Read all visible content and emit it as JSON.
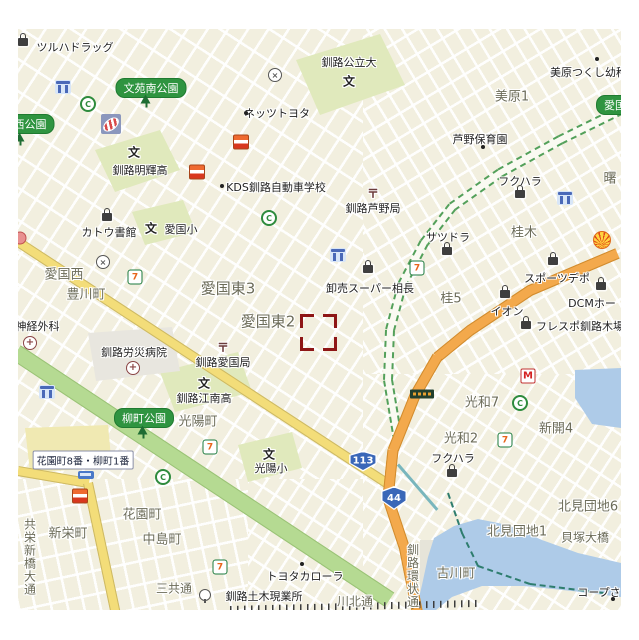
{
  "map": {
    "x": 18,
    "y": 29,
    "w": 603,
    "h": 581,
    "selection": {
      "x": 282,
      "y": 285,
      "w": 37,
      "h": 37
    },
    "colors": {
      "base": "#f2efdf",
      "road_yellow": "#f3dd79",
      "road_orange": "#f3a94c",
      "park_green": "#b5da92",
      "campus_green": "#e0e9bc",
      "water": "#aecbe8",
      "pill_green": "#2f9440",
      "selection_red": "#8e1616",
      "shield_blue": "#3a67b8"
    },
    "areas": [
      {
        "t": "美原1",
        "x": 512,
        "y": 95
      },
      {
        "t": "曙",
        "x": 610,
        "y": 177
      },
      {
        "t": "桂木",
        "x": 524,
        "y": 231
      },
      {
        "t": "桂5",
        "x": 451,
        "y": 297
      },
      {
        "t": "愛国西",
        "x": 64,
        "y": 273
      },
      {
        "t": "豊川町",
        "x": 86,
        "y": 293
      },
      {
        "t": "愛国東3",
        "x": 228,
        "y": 288,
        "s": 15
      },
      {
        "t": "愛国東2",
        "x": 268,
        "y": 321,
        "s": 15
      },
      {
        "t": "光陽町",
        "x": 198,
        "y": 420
      },
      {
        "t": "新栄町",
        "x": 68,
        "y": 532
      },
      {
        "t": "花園町",
        "x": 142,
        "y": 513
      },
      {
        "t": "中島町",
        "x": 162,
        "y": 538
      },
      {
        "t": "三共通",
        "x": 174,
        "y": 588,
        "s": 12
      },
      {
        "t": "光和7",
        "x": 482,
        "y": 401
      },
      {
        "t": "光和2",
        "x": 461,
        "y": 437
      },
      {
        "t": "新開4",
        "x": 556,
        "y": 427
      },
      {
        "t": "北見団地1",
        "x": 517,
        "y": 530
      },
      {
        "t": "北見団地6",
        "x": 588,
        "y": 505
      },
      {
        "t": "古川町",
        "x": 456,
        "y": 572
      },
      {
        "t": "貝塚大橋",
        "x": 585,
        "y": 537,
        "s": 12
      },
      {
        "t": "川北通",
        "x": 355,
        "y": 601,
        "s": 12
      }
    ],
    "pois": [
      {
        "t": "ツルハドラッグ",
        "x": 75,
        "y": 47
      },
      {
        "t": "釧路公立大",
        "x": 349,
        "y": 62
      },
      {
        "t": "ネッツトヨタ",
        "x": 277,
        "y": 113
      },
      {
        "t": "釧路明輝高",
        "x": 140,
        "y": 170
      },
      {
        "t": "カトウ書館",
        "x": 109,
        "y": 232
      },
      {
        "t": "愛国小",
        "x": 181,
        "y": 229
      },
      {
        "t": "KDS釧路自動車学校",
        "x": 276,
        "y": 187
      },
      {
        "t": "釧路芦野局",
        "x": 373,
        "y": 208
      },
      {
        "t": "サツドラ",
        "x": 448,
        "y": 237
      },
      {
        "t": "卸売スーパー相長",
        "x": 370,
        "y": 288
      },
      {
        "t": "スポーツデポ",
        "x": 557,
        "y": 278
      },
      {
        "t": "イオン",
        "x": 507,
        "y": 311
      },
      {
        "t": "DCMホー",
        "x": 592,
        "y": 303
      },
      {
        "t": "フレスポ釧路木場",
        "x": 580,
        "y": 326
      },
      {
        "t": "フクハラ",
        "x": 520,
        "y": 181
      },
      {
        "t": "フクハラ",
        "x": 453,
        "y": 458
      },
      {
        "t": "美原つくし幼稚園",
        "x": 594,
        "y": 72
      },
      {
        "t": "芦野保育園",
        "x": 480,
        "y": 139
      },
      {
        "t": "釧路労災病院",
        "x": 134,
        "y": 352
      },
      {
        "t": "釧路愛国局",
        "x": 223,
        "y": 362
      },
      {
        "t": "釧路江南高",
        "x": 204,
        "y": 398
      },
      {
        "t": "光陽小",
        "x": 271,
        "y": 468
      },
      {
        "t": "脳神経外科",
        "x": 32,
        "y": 326
      },
      {
        "t": "トヨタカローラ",
        "x": 305,
        "y": 576
      },
      {
        "t": "釧路土木現業所",
        "x": 264,
        "y": 596
      },
      {
        "t": "コープさ",
        "x": 599,
        "y": 592
      }
    ],
    "pills": [
      {
        "t": "文苑南公園",
        "x": 151,
        "y": 88
      },
      {
        "t": "西公園",
        "x": 30,
        "y": 124
      },
      {
        "t": "柳町公園",
        "x": 144,
        "y": 418
      },
      {
        "t": "愛国",
        "x": 615,
        "y": 105
      }
    ],
    "crossings": [
      {
        "t": "花園町8番・柳町1番",
        "x": 83,
        "y": 460
      }
    ],
    "verticals": [
      {
        "t": "共栄新橋大通",
        "x": 30,
        "y": 557
      },
      {
        "t": "釧路環状通",
        "x": 413,
        "y": 576
      }
    ],
    "shields": [
      {
        "t": "113",
        "x": 363,
        "y": 461,
        "w": 30,
        "h": 21
      },
      {
        "t": "44",
        "x": 394,
        "y": 498,
        "w": 28,
        "h": 24
      }
    ],
    "glyphs": [
      {
        "k": "school",
        "t": "文",
        "x": 349,
        "y": 81
      },
      {
        "k": "school",
        "t": "文",
        "x": 134,
        "y": 152
      },
      {
        "k": "school",
        "t": "文",
        "x": 151,
        "y": 228
      },
      {
        "k": "school",
        "t": "文",
        "x": 204,
        "y": 383
      },
      {
        "k": "school",
        "t": "文",
        "x": 269,
        "y": 454
      },
      {
        "k": "post",
        "t": "〒",
        "x": 373,
        "y": 193
      },
      {
        "k": "post",
        "t": "〒",
        "x": 223,
        "y": 347
      }
    ],
    "icons": [
      {
        "k": "bag",
        "x": 23,
        "y": 42
      },
      {
        "k": "bag",
        "x": 107,
        "y": 217
      },
      {
        "k": "bag",
        "x": 368,
        "y": 269
      },
      {
        "k": "bag",
        "x": 447,
        "y": 251
      },
      {
        "k": "bag",
        "x": 553,
        "y": 261
      },
      {
        "k": "bag",
        "x": 505,
        "y": 294
      },
      {
        "k": "bag",
        "x": 601,
        "y": 286
      },
      {
        "k": "bag",
        "x": 526,
        "y": 325
      },
      {
        "k": "bag",
        "x": 520,
        "y": 194
      },
      {
        "k": "bag",
        "x": 452,
        "y": 473
      },
      {
        "k": "seven",
        "x": 135,
        "y": 277
      },
      {
        "k": "seven",
        "x": 417,
        "y": 268
      },
      {
        "k": "seven",
        "x": 210,
        "y": 447
      },
      {
        "k": "seven",
        "x": 220,
        "y": 567
      },
      {
        "k": "seven",
        "x": 505,
        "y": 440
      },
      {
        "k": "seico",
        "x": 197,
        "y": 172
      },
      {
        "k": "seico",
        "x": 241,
        "y": 142
      },
      {
        "k": "seico",
        "x": 80,
        "y": 496
      },
      {
        "k": "c",
        "x": 88,
        "y": 104
      },
      {
        "k": "c",
        "x": 269,
        "y": 218
      },
      {
        "k": "c",
        "x": 163,
        "y": 477
      },
      {
        "k": "c",
        "x": 520,
        "y": 403
      },
      {
        "k": "landmark",
        "x": 63,
        "y": 87
      },
      {
        "k": "landmark",
        "x": 338,
        "y": 255
      },
      {
        "k": "landmark",
        "x": 565,
        "y": 198
      },
      {
        "k": "landmark",
        "x": 47,
        "y": 392
      },
      {
        "k": "tree",
        "x": 146,
        "y": 101
      },
      {
        "k": "tree",
        "x": 20,
        "y": 139
      },
      {
        "k": "tree",
        "x": 143,
        "y": 432
      },
      {
        "k": "police",
        "x": 275,
        "y": 75
      },
      {
        "k": "police",
        "x": 103,
        "y": 262
      },
      {
        "k": "hospital",
        "x": 30,
        "y": 343
      },
      {
        "k": "hospital",
        "x": 133,
        "y": 368
      },
      {
        "k": "shell",
        "x": 602,
        "y": 240
      },
      {
        "k": "mcd",
        "x": 528,
        "y": 376
      },
      {
        "k": "stripedoval",
        "x": 111,
        "y": 124
      },
      {
        "k": "flower",
        "x": 20,
        "y": 238
      },
      {
        "k": "bus",
        "x": 86,
        "y": 475
      },
      {
        "k": "sign",
        "x": 422,
        "y": 394
      },
      {
        "k": "gov",
        "x": 205,
        "y": 595
      },
      {
        "k": "dot",
        "x": 246,
        "y": 113
      },
      {
        "k": "dot",
        "x": 222,
        "y": 186
      },
      {
        "k": "dot",
        "x": 302,
        "y": 564
      },
      {
        "k": "dot",
        "x": 483,
        "y": 147
      },
      {
        "k": "dot",
        "x": 597,
        "y": 59
      },
      {
        "k": "dot",
        "x": 613,
        "y": 599
      }
    ],
    "icon_glyphs": {
      "seven": "7",
      "c": "C",
      "mcd": "M",
      "hospital": "+",
      "police": "×"
    }
  }
}
